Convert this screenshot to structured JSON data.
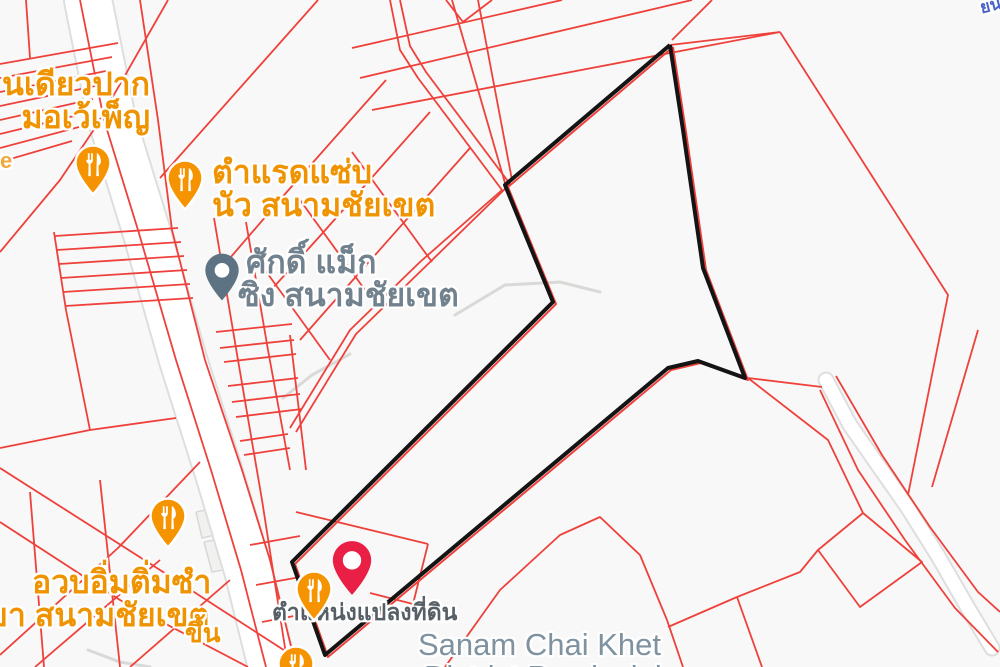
{
  "map": {
    "background_color": "#f7f8f7",
    "colors": {
      "cadastral_line": "#ef413b",
      "parcel_outline": "#141414",
      "road_fill": "#ffffff",
      "road_casing": "#dedede",
      "building_fill": "#f1f1f0",
      "building_stroke": "#d8d8d6",
      "gray_path": "#d9d9d7",
      "restaurant_pin": "#f59300",
      "place_pin": "#5d7384",
      "red_marker": "#e91f45",
      "poi_label_orange": "#ef9400",
      "poi_label_gray": "#71828e",
      "district_label": "#7e929f",
      "parcel_note_label": "#565f66"
    },
    "labels": {
      "poi_topleft": {
        "line1": "นเดียวปาก",
        "line2": "มอเว้เพ็ญ"
      },
      "street_fragment": "e",
      "poi_tamrad": {
        "line1": "ตำแรดแซ่บ",
        "line2": "นัว สนามชัยเขต"
      },
      "poi_sakdi": {
        "line1": "ศักดิ์ แม็ก",
        "line2": "ซิง สนามชัยเขต"
      },
      "poi_dimsum": {
        "line1": "อวบอิ่มติ่มซำ",
        "line2": "ขา สนามชัยเขต"
      },
      "fragment_khuen": "ขึ้น",
      "parcel_marker_note": "ตำแหน่งแปลงที่ดิน",
      "district": {
        "line1": "Sanam Chai Khet",
        "line2": "District Provincial"
      },
      "fragment_topright": "ยน"
    },
    "markers": [
      {
        "icon": "restaurant-pin-icon",
        "kind": "restaurant",
        "x": 93,
        "y": 163
      },
      {
        "icon": "restaurant-pin-icon",
        "kind": "restaurant",
        "x": 185,
        "y": 178
      },
      {
        "icon": "restaurant-pin-icon",
        "kind": "restaurant",
        "x": 168,
        "y": 516
      },
      {
        "icon": "restaurant-pin-icon",
        "kind": "restaurant",
        "x": 314,
        "y": 589
      },
      {
        "icon": "restaurant-pin-icon",
        "kind": "restaurant",
        "x": 296,
        "y": 664
      },
      {
        "icon": "place-pin-icon",
        "kind": "place",
        "x": 222,
        "y": 270
      },
      {
        "icon": "red-map-pin-icon",
        "kind": "parcel-location",
        "x": 352,
        "y": 560
      }
    ],
    "geometry": {
      "parcel_polygon": [
        [
          670,
          45
        ],
        [
          683,
          130
        ],
        [
          703,
          268
        ],
        [
          745,
          378
        ],
        [
          698,
          361
        ],
        [
          668,
          368
        ],
        [
          325,
          655
        ],
        [
          292,
          562
        ],
        [
          553,
          302
        ],
        [
          505,
          185
        ]
      ],
      "roads": {
        "main_road": {
          "path": [
            [
              88,
              0
            ],
            [
              112,
              120
            ],
            [
              146,
              230
            ],
            [
              183,
              360
            ],
            [
              218,
              470
            ],
            [
              248,
              570
            ],
            [
              272,
              667
            ]
          ],
          "width": 46
        },
        "curved_road": {
          "path": [
            [
              826,
              380
            ],
            [
              850,
              425
            ],
            [
              880,
              468
            ],
            [
              908,
              508
            ],
            [
              938,
              556
            ],
            [
              968,
              608
            ],
            [
              992,
              648
            ]
          ],
          "width": 13
        }
      },
      "gray_paths": [
        [
          [
            283,
            398
          ],
          [
            312,
            375
          ],
          [
            350,
            354
          ]
        ],
        [
          [
            455,
            315
          ],
          [
            505,
            285
          ],
          [
            560,
            282
          ],
          [
            600,
            292
          ]
        ],
        [
          [
            88,
            650
          ],
          [
            120,
            662
          ],
          [
            150,
            667
          ]
        ]
      ],
      "buildings": [
        [
          [
            196,
            512
          ],
          [
            230,
            505
          ],
          [
            236,
            530
          ],
          [
            202,
            538
          ]
        ],
        [
          [
            204,
            542
          ],
          [
            248,
            534
          ],
          [
            256,
            564
          ],
          [
            212,
            572
          ]
        ]
      ],
      "red_lines": [
        [
          [
            168,
            0
          ],
          [
            95,
            128
          ],
          [
            60,
            180
          ],
          [
            0,
            252
          ]
        ],
        [
          [
            0,
            64
          ],
          [
            118,
            43
          ]
        ],
        [
          [
            0,
            78
          ],
          [
            112,
            57
          ]
        ],
        [
          [
            0,
            92
          ],
          [
            106,
            71
          ]
        ],
        [
          [
            0,
            106
          ],
          [
            100,
            85
          ]
        ],
        [
          [
            0,
            120
          ],
          [
            93,
            99
          ]
        ],
        [
          [
            0,
            134
          ],
          [
            86,
            113
          ]
        ],
        [
          [
            0,
            148
          ],
          [
            79,
            127
          ]
        ],
        [
          [
            0,
            162
          ],
          [
            72,
            141
          ]
        ],
        [
          [
            26,
            0
          ],
          [
            30,
            58
          ]
        ],
        [
          [
            54,
            232
          ],
          [
            66,
            310
          ]
        ],
        [
          [
            55,
            236
          ],
          [
            178,
            228
          ]
        ],
        [
          [
            57,
            250
          ],
          [
            181,
            242
          ]
        ],
        [
          [
            59,
            264
          ],
          [
            184,
            256
          ]
        ],
        [
          [
            61,
            278
          ],
          [
            187,
            270
          ]
        ],
        [
          [
            63,
            292
          ],
          [
            190,
            284
          ]
        ],
        [
          [
            65,
            306
          ],
          [
            193,
            298
          ]
        ],
        [
          [
            66,
            310
          ],
          [
            90,
            430
          ]
        ],
        [
          [
            90,
            430
          ],
          [
            0,
            448
          ]
        ],
        [
          [
            90,
            430
          ],
          [
            176,
            418
          ]
        ],
        [
          [
            0,
            468
          ],
          [
            160,
            570
          ],
          [
            310,
            667
          ]
        ],
        [
          [
            0,
            522
          ],
          [
            120,
            600
          ],
          [
            248,
            667
          ]
        ],
        [
          [
            0,
            655
          ],
          [
            118,
            548
          ],
          [
            200,
            462
          ]
        ],
        [
          [
            30,
            492
          ],
          [
            44,
            667
          ]
        ],
        [
          [
            100,
            480
          ],
          [
            120,
            667
          ]
        ],
        [
          [
            35,
            667
          ],
          [
            160,
            560
          ]
        ],
        [
          [
            130,
            667
          ],
          [
            230,
            580
          ]
        ],
        [
          [
            80,
            0
          ],
          [
            104,
            120
          ],
          [
            138,
            230
          ],
          [
            176,
            360
          ],
          [
            211,
            470
          ],
          [
            241,
            570
          ],
          [
            266,
            667
          ]
        ],
        [
          [
            140,
            0
          ],
          [
            158,
            120
          ],
          [
            172,
            230
          ],
          [
            205,
            360
          ],
          [
            242,
            470
          ],
          [
            270,
            560
          ],
          [
            296,
            667
          ]
        ],
        [
          [
            214,
            218
          ],
          [
            238,
            360
          ],
          [
            262,
            500
          ],
          [
            288,
            667
          ]
        ],
        [
          [
            246,
            222
          ],
          [
            268,
            350
          ],
          [
            290,
            470
          ]
        ],
        [
          [
            290,
            335
          ],
          [
            306,
            470
          ]
        ],
        [
          [
            216,
            332
          ],
          [
            292,
            324
          ]
        ],
        [
          [
            220,
            348
          ],
          [
            294,
            340
          ]
        ],
        [
          [
            224,
            362
          ],
          [
            296,
            354
          ]
        ],
        [
          [
            228,
            386
          ],
          [
            298,
            378
          ]
        ],
        [
          [
            232,
            402
          ],
          [
            300,
            394
          ]
        ],
        [
          [
            236,
            417
          ],
          [
            302,
            409
          ]
        ],
        [
          [
            240,
            441
          ],
          [
            288,
            434
          ]
        ],
        [
          [
            244,
            455
          ],
          [
            290,
            448
          ]
        ],
        [
          [
            250,
            545
          ],
          [
            300,
            536
          ]
        ],
        [
          [
            256,
            585
          ],
          [
            306,
            576
          ]
        ],
        [
          [
            262,
            622
          ],
          [
            310,
            613
          ]
        ],
        [
          [
            352,
            152
          ],
          [
            432,
            262
          ]
        ],
        [
          [
            300,
            200
          ],
          [
            378,
            308
          ]
        ],
        [
          [
            252,
            252
          ],
          [
            330,
            360
          ]
        ],
        [
          [
            470,
            148
          ],
          [
            360,
            272
          ],
          [
            300,
            340
          ]
        ],
        [
          [
            430,
            112
          ],
          [
            320,
            236
          ],
          [
            262,
            300
          ]
        ],
        [
          [
            386,
            80
          ],
          [
            285,
            194
          ],
          [
            230,
            258
          ]
        ],
        [
          [
            390,
            0
          ],
          [
            400,
            50
          ],
          [
            418,
            78
          ],
          [
            502,
            190
          ],
          [
            420,
            262
          ],
          [
            350,
            330
          ],
          [
            290,
            428
          ]
        ],
        [
          [
            400,
            0
          ],
          [
            410,
            46
          ],
          [
            426,
            72
          ],
          [
            510,
            184
          ],
          [
            426,
            266
          ],
          [
            356,
            334
          ],
          [
            296,
            432
          ]
        ],
        [
          [
            318,
            0
          ],
          [
            160,
            178
          ]
        ],
        [
          [
            352,
            48
          ],
          [
            562,
            0
          ]
        ],
        [
          [
            360,
            78
          ],
          [
            692,
            0
          ]
        ],
        [
          [
            372,
            110
          ],
          [
            780,
            32
          ]
        ],
        [
          [
            780,
            32
          ],
          [
            948,
            295
          ],
          [
            908,
            495
          ]
        ],
        [
          [
            978,
            330
          ],
          [
            932,
            487
          ]
        ],
        [
          [
            748,
            378
          ],
          [
            822,
            387
          ]
        ],
        [
          [
            748,
            378
          ],
          [
            828,
            440
          ],
          [
            863,
            513
          ]
        ],
        [
          [
            820,
            390
          ],
          [
            858,
            470
          ],
          [
            905,
            540
          ],
          [
            955,
            608
          ],
          [
            998,
            652
          ]
        ],
        [
          [
            836,
            376
          ],
          [
            882,
            455
          ],
          [
            930,
            527
          ],
          [
            978,
            592
          ],
          [
            1000,
            612
          ]
        ],
        [
          [
            863,
            513
          ],
          [
            922,
            562
          ],
          [
            860,
            607
          ],
          [
            818,
            550
          ],
          [
            863,
            513
          ]
        ],
        [
          [
            445,
            667
          ],
          [
            500,
            590
          ],
          [
            560,
            535
          ],
          [
            600,
            517
          ],
          [
            640,
            555
          ],
          [
            667,
            620
          ],
          [
            683,
            667
          ]
        ],
        [
          [
            668,
            627
          ],
          [
            737,
            597
          ]
        ],
        [
          [
            737,
            597
          ],
          [
            762,
            667
          ]
        ],
        [
          [
            737,
            597
          ],
          [
            800,
            572
          ],
          [
            818,
            550
          ]
        ],
        [
          [
            296,
            512
          ],
          [
            428,
            544
          ]
        ],
        [
          [
            428,
            544
          ],
          [
            413,
            604
          ]
        ],
        [
          [
            370,
            593
          ],
          [
            413,
            604
          ]
        ],
        [
          [
            446,
            0
          ],
          [
            463,
            22
          ],
          [
            492,
            0
          ]
        ],
        [
          [
            452,
            0
          ],
          [
            505,
            183
          ]
        ],
        [
          [
            478,
            0
          ],
          [
            512,
            180
          ]
        ],
        [
          [
            670,
            45
          ],
          [
            780,
            32
          ]
        ],
        [
          [
            672,
            40
          ],
          [
            712,
            0
          ]
        ]
      ]
    }
  }
}
